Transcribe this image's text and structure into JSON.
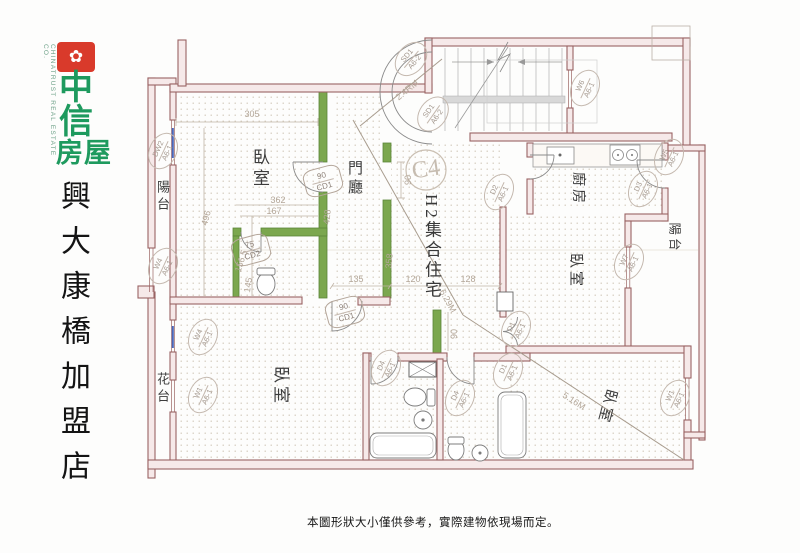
{
  "branding": {
    "icon_glyph": "✿",
    "company_c1": "中",
    "company_c2": "信",
    "company_c3": "房屋",
    "company_en": "CHINATRUST REAL ESTATE CO.",
    "store_name": "興大康橋加盟店",
    "brand_red": "#d93a2b",
    "brand_green": "#1e9a5e"
  },
  "plan": {
    "unit_code": "C4",
    "unit_type": "H2集合住宅",
    "rooms": [
      {
        "id": "bedroom-top-left",
        "label": "臥室"
      },
      {
        "id": "entry-hall",
        "label": "門廳"
      },
      {
        "id": "kitchen",
        "label": "廚房"
      },
      {
        "id": "balcony-left",
        "label": "陽台"
      },
      {
        "id": "balcony-right",
        "label": "陽台"
      },
      {
        "id": "bedroom-right",
        "label": "臥室"
      },
      {
        "id": "bedroom-bottom-left",
        "label": "臥室"
      },
      {
        "id": "bedroom-bottom-right",
        "label": "臥室"
      },
      {
        "id": "planter",
        "label": "花台"
      }
    ],
    "dimensions": [
      {
        "value": "305"
      },
      {
        "value": "496"
      },
      {
        "value": "362"
      },
      {
        "value": "167"
      },
      {
        "value": "428"
      },
      {
        "value": "358"
      },
      {
        "value": "156.5"
      },
      {
        "value": "145"
      },
      {
        "value": "90"
      },
      {
        "value": "90"
      },
      {
        "value": "135"
      },
      {
        "value": "120"
      },
      {
        "value": "128"
      },
      {
        "value": "2.4RM"
      },
      {
        "value": "6.29M"
      },
      {
        "value": "5.16M"
      }
    ],
    "tags": [
      {
        "code": "DW2",
        "sheet": "A6-1"
      },
      {
        "code": "W4",
        "sheet": "A6-1"
      },
      {
        "code": "SD1",
        "sheet": "A6-2"
      },
      {
        "code": "SD1",
        "sheet": "A6-2"
      },
      {
        "code": "W6",
        "sheet": "A6-1"
      },
      {
        "code": "W5",
        "sheet": "A6-1"
      },
      {
        "code": "D3",
        "sheet": "A6-1"
      },
      {
        "code": "D2",
        "sheet": "A6-1"
      },
      {
        "code": "W7",
        "sheet": "A6-1"
      },
      {
        "code": "90",
        "sheet": "CD1"
      },
      {
        "code": "75",
        "sheet": "CD2"
      },
      {
        "code": "90",
        "sheet": "CD1"
      },
      {
        "code": "W4",
        "sheet": "A6-1"
      },
      {
        "code": "W1",
        "sheet": "A6-1"
      },
      {
        "code": "D4",
        "sheet": "A6-1"
      },
      {
        "code": "D4",
        "sheet": "A6-1"
      },
      {
        "code": "D1",
        "sheet": "A6-1"
      },
      {
        "code": "D1",
        "sheet": "A6-1"
      },
      {
        "code": "W1",
        "sheet": "A6-1"
      }
    ],
    "disclaimer": "本圖形狀大小僅供參考，實際建物依現場而定。",
    "colors": {
      "wall": "#9a6363",
      "green_wall": "#7ba74e"
    }
  }
}
